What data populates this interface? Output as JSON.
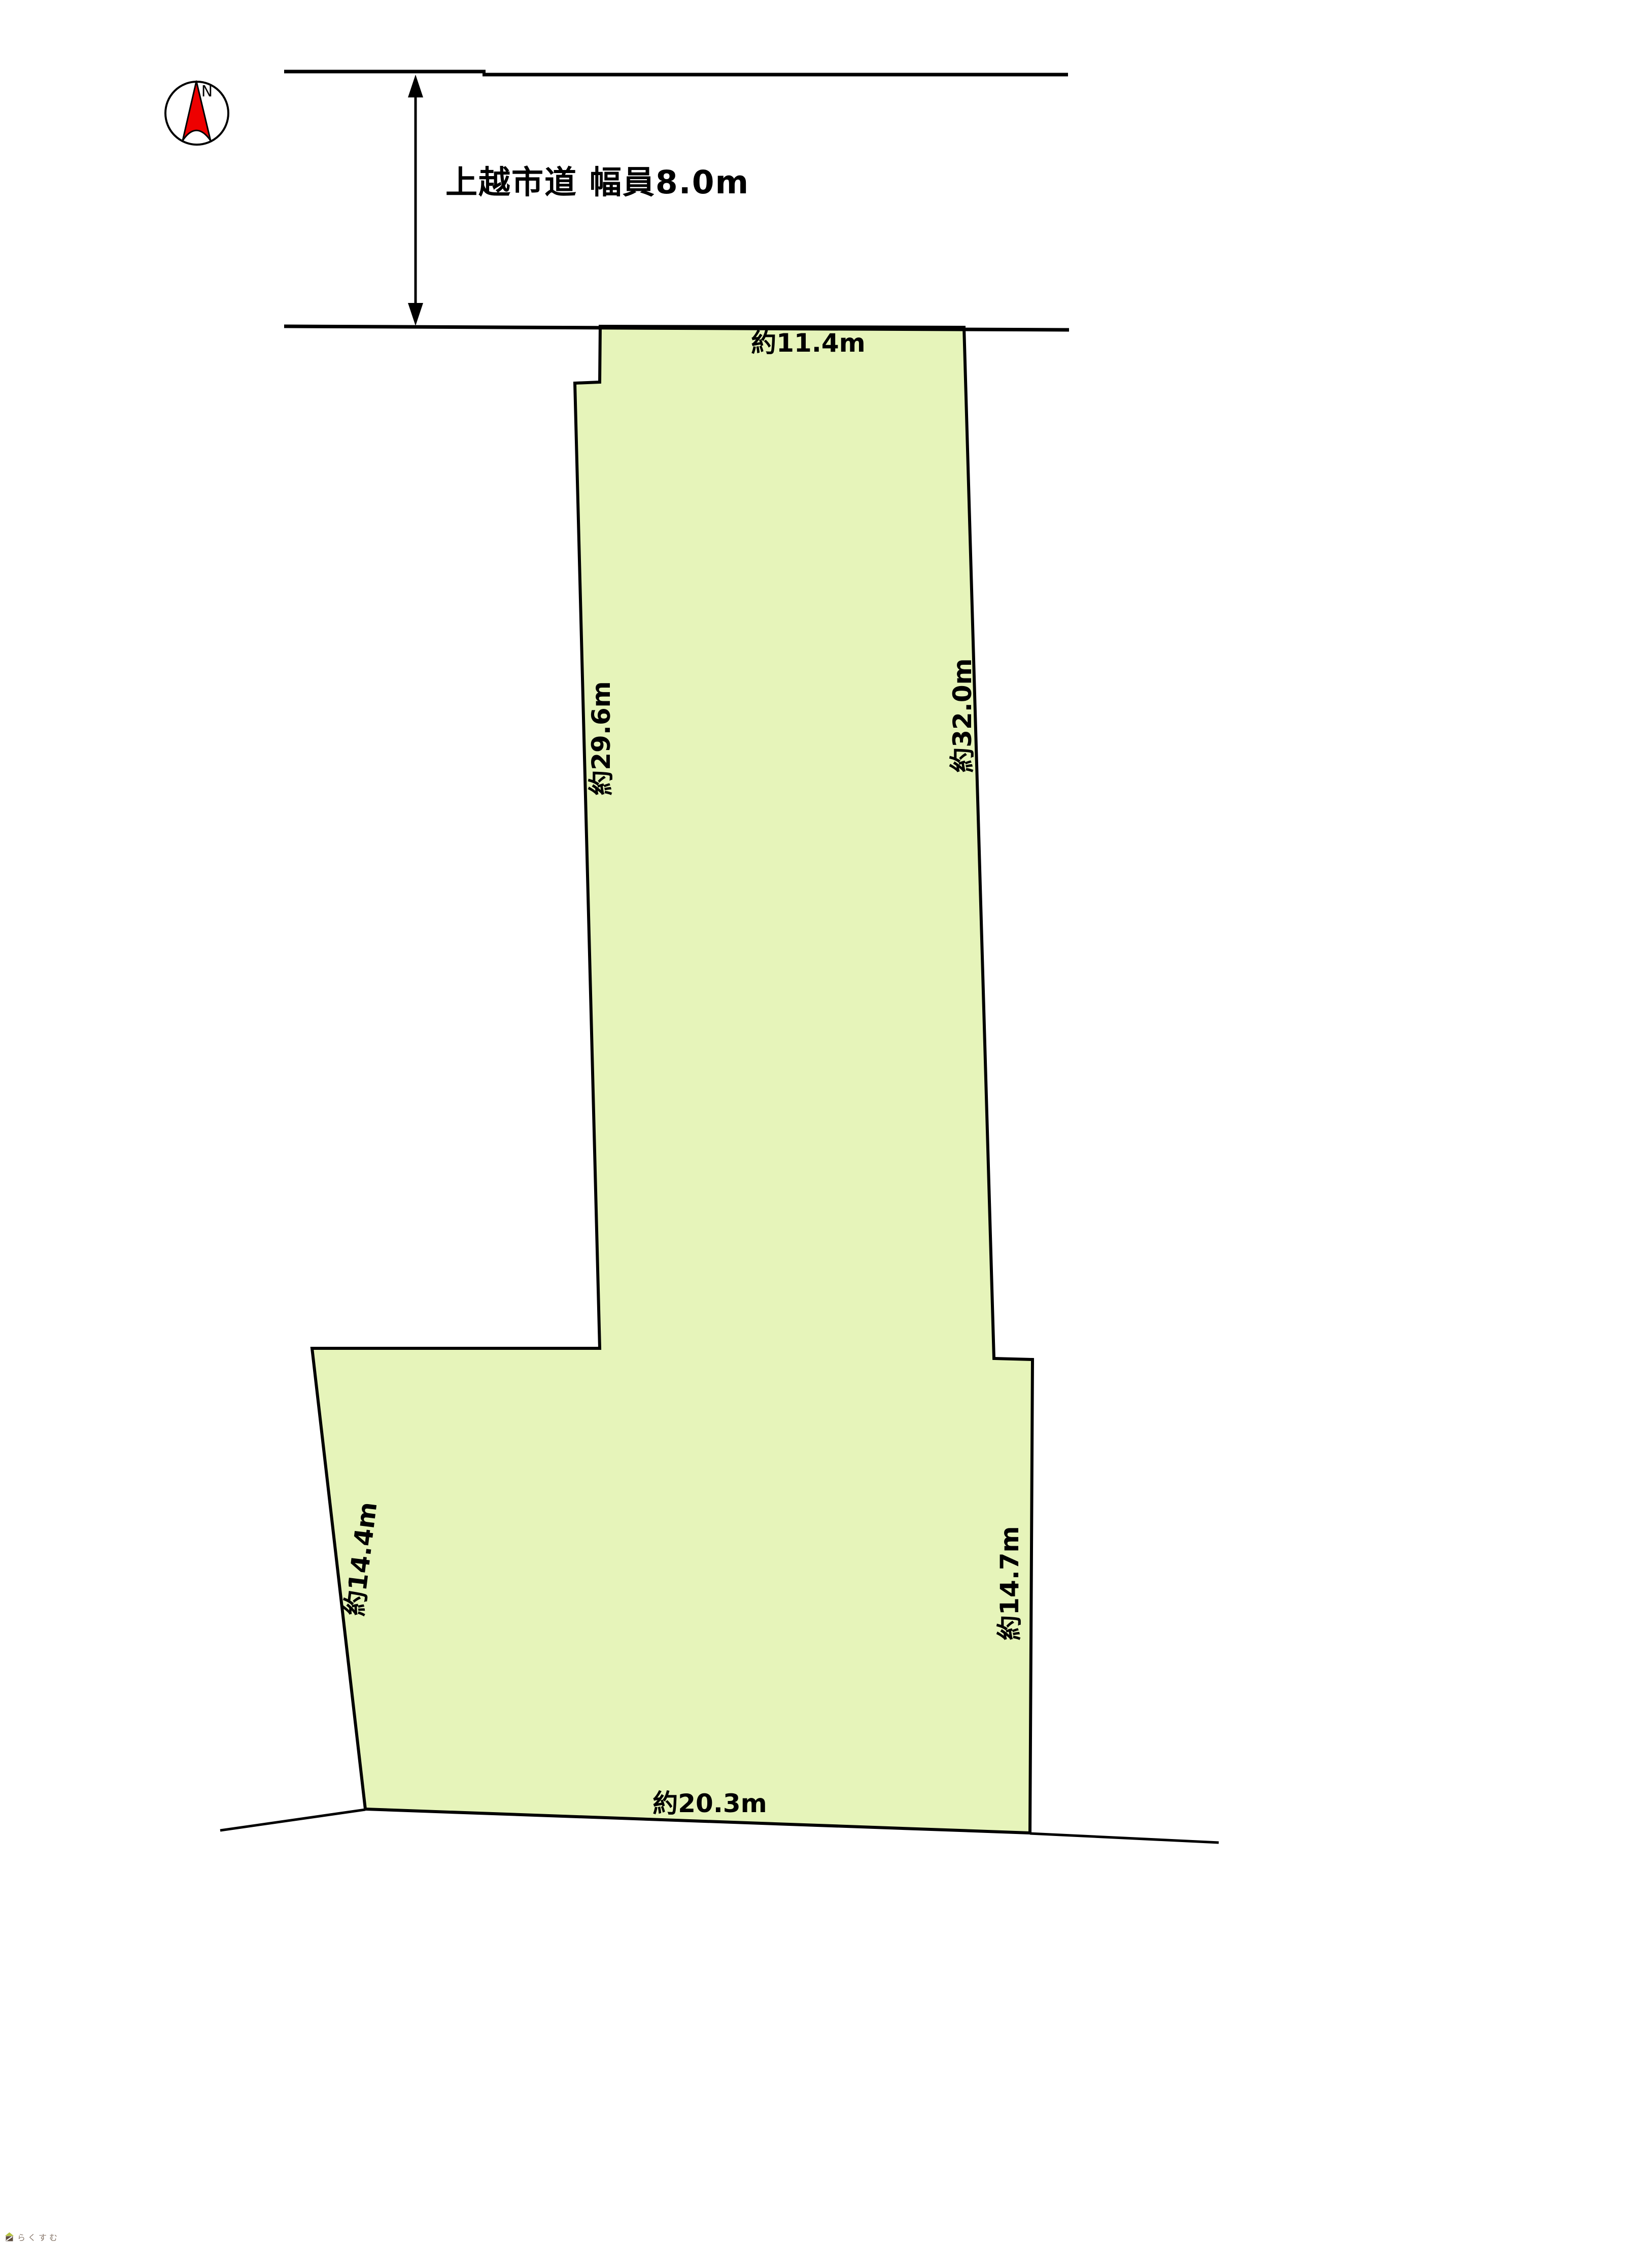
{
  "page": {
    "background": "#ffffff"
  },
  "compass": {
    "label": "N",
    "needle_color": "#ee0000"
  },
  "road": {
    "label": "上越市道 幅員8.0m"
  },
  "plot": {
    "fill_color": "#e6f4ba",
    "outline_color": "#000000",
    "dimensions": {
      "top": "約11.4m",
      "side_upper_left": "約29.6m",
      "side_upper_right": "約32.0m",
      "side_lower_left": "約14.4m",
      "side_lower_right": "約14.7m",
      "bottom": "約20.3m"
    }
  },
  "watermark": {
    "text": "らくすむ"
  }
}
